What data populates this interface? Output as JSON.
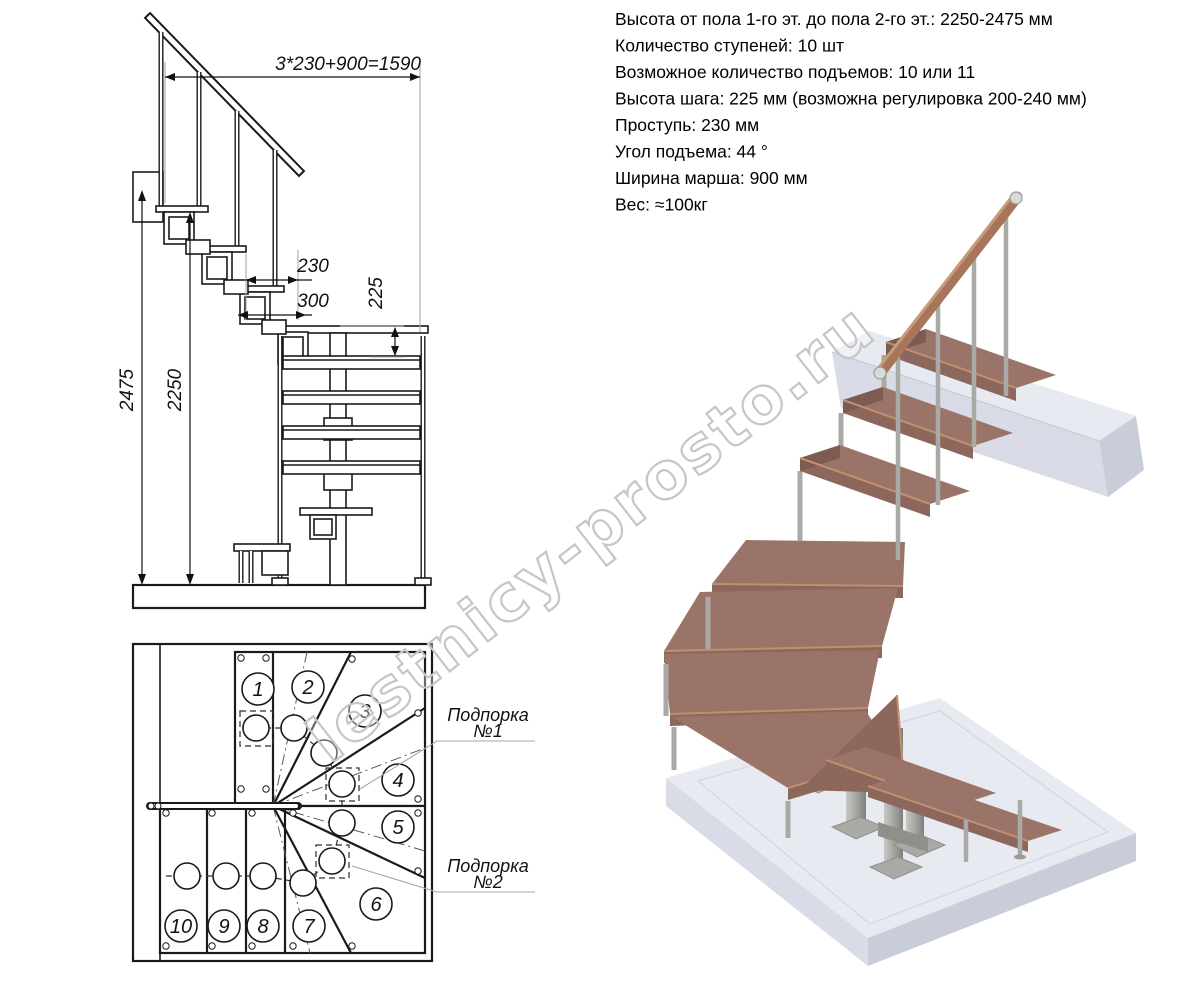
{
  "specs": {
    "lines": [
      "Высота от пола 1-го эт. до пола 2-го эт.: 2250-2475 мм",
      "Количество ступеней: 10 шт",
      "Возможное количество подъемов: 10 или 11",
      "Высота шага: 225 мм (возможна регулировка 200-240 мм)",
      "Проступь: 230 мм",
      "Угол подъема: 44 °",
      "Ширина марша: 900 мм",
      "Вес: ≈100кг"
    ]
  },
  "elevation": {
    "dim_total": "3*230+900=1590",
    "dim_tread": "230",
    "dim_platform": "300",
    "dim_rise": "225",
    "dim_height_max": "2475",
    "dim_height_min": "2250"
  },
  "plan": {
    "steps": [
      "1",
      "2",
      "3",
      "4",
      "5",
      "6",
      "7",
      "8",
      "9",
      "10"
    ],
    "support1": {
      "line1": "Подпорка",
      "line2": "№1"
    },
    "support2": {
      "line1": "Подпорка",
      "line2": "№2"
    }
  },
  "watermark": {
    "text": "lestnicy-prosto.ru"
  },
  "colors": {
    "wood": "#9a7468",
    "wood_dark": "#7d5a52",
    "wood_face": "#8d665c",
    "wood_light": "#c08f70",
    "handrail": "#a8755a",
    "steel": "#a9aaa6",
    "steel_dark": "#8f9089",
    "slab_top": "#e8eaf2",
    "slab_side": "#d9dce7",
    "slab_edge": "#c9cdd9",
    "watermark": "#c6c6c6",
    "line": "#1a1a1a"
  }
}
